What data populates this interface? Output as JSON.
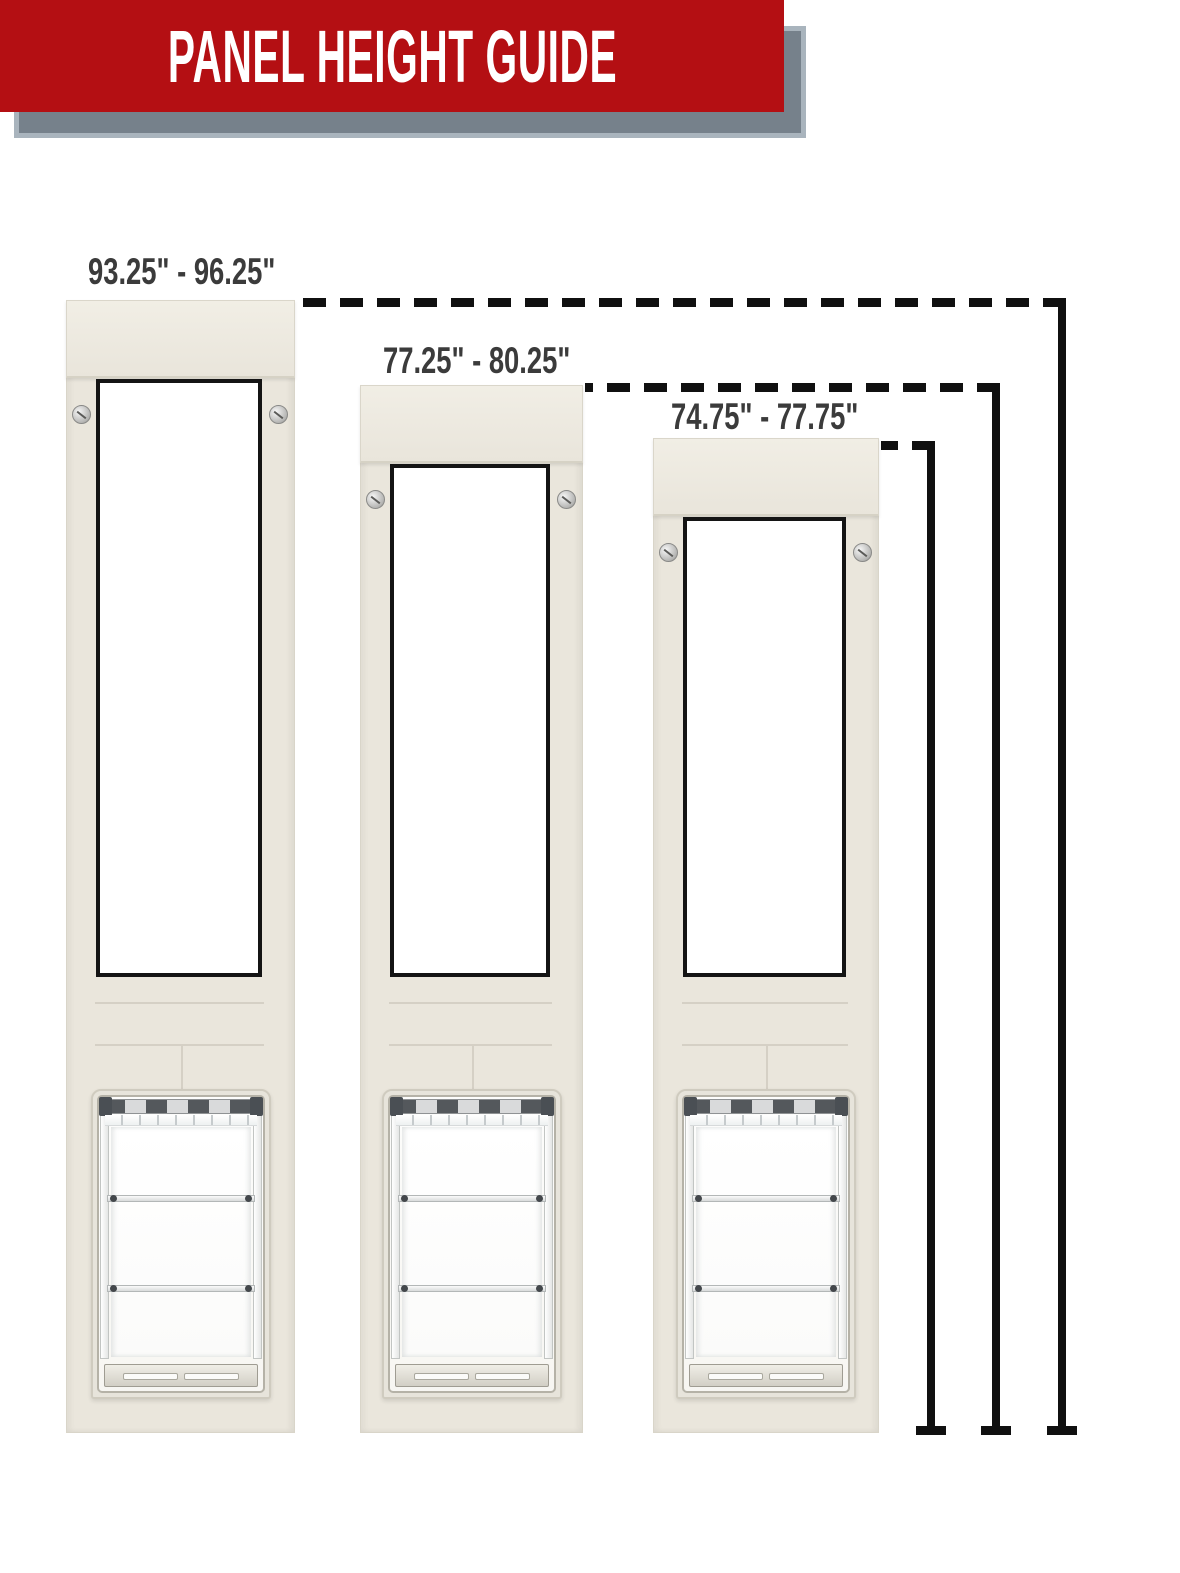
{
  "banner": {
    "title": "PANEL HEIGHT GUIDE"
  },
  "panels": [
    {
      "id": "tall-panel",
      "height_range_label": "93.25\" - 96.25\""
    },
    {
      "id": "medium-panel",
      "height_range_label": "77.25\" - 80.25\""
    },
    {
      "id": "short-panel",
      "height_range_label": "74.75\" - 77.75\""
    }
  ],
  "colors": {
    "banner_red": "#B40F13",
    "banner_shadow_gray": "#76818B",
    "banner_shadow_border": "#A9B4BD",
    "panel_cream": "#EAE6DC",
    "window_border_black": "#141414",
    "measurement_line_black": "#101010",
    "label_text_gray": "#3B3B3B",
    "background": "#FFFFFF"
  }
}
